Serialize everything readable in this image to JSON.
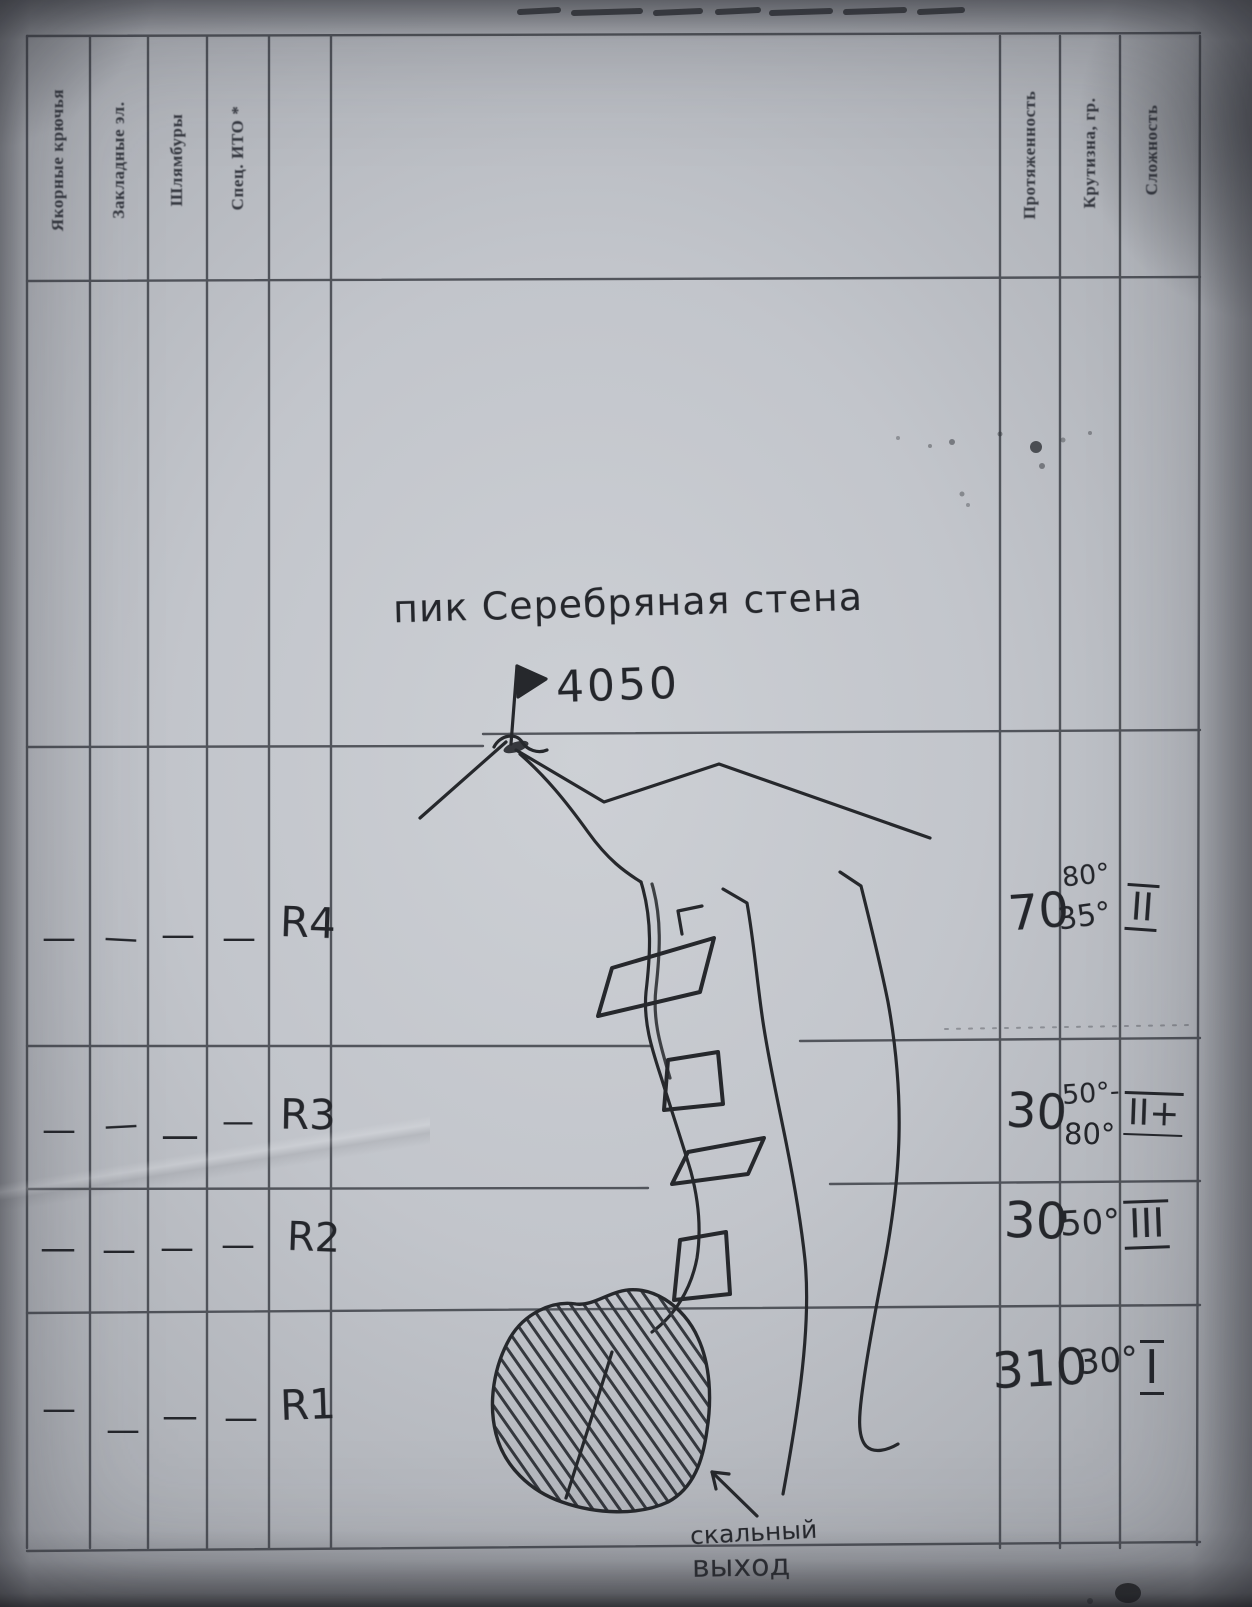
{
  "form": {
    "left_headers": [
      "Якорные крючья",
      "Закладные эл.",
      "Шлямбуры",
      "Спец. ИТО *"
    ],
    "right_headers": [
      "Протяженность",
      "Крутизна, гр.",
      "Сложность"
    ]
  },
  "sketch": {
    "title": "пик Серебряная стена",
    "elevation": "4050",
    "outcrop_line1": "скальный",
    "outcrop_line2": "выход"
  },
  "rows": [
    {
      "label": "R4",
      "gear": [
        "—",
        "—",
        "—",
        "—"
      ],
      "length": "70",
      "steepness": [
        "80°",
        "35°"
      ],
      "difficulty": "II"
    },
    {
      "label": "R3",
      "gear": [
        "—",
        "—",
        "—",
        "—"
      ],
      "length": "30",
      "steepness": [
        "50°-",
        "80°"
      ],
      "difficulty": "II+"
    },
    {
      "label": "R2",
      "gear": [
        "—",
        "—",
        "—",
        "—"
      ],
      "length": "30",
      "steepness": [
        "50°"
      ],
      "difficulty": "III"
    },
    {
      "label": "R1",
      "gear": [
        "—",
        "—",
        "—",
        "—"
      ],
      "length": "310",
      "steepness": [
        "30°"
      ],
      "difficulty": "I"
    }
  ],
  "colors": {
    "ink": "#24262b",
    "printed_line": "#42454c",
    "paper": "#c2c5cb"
  }
}
